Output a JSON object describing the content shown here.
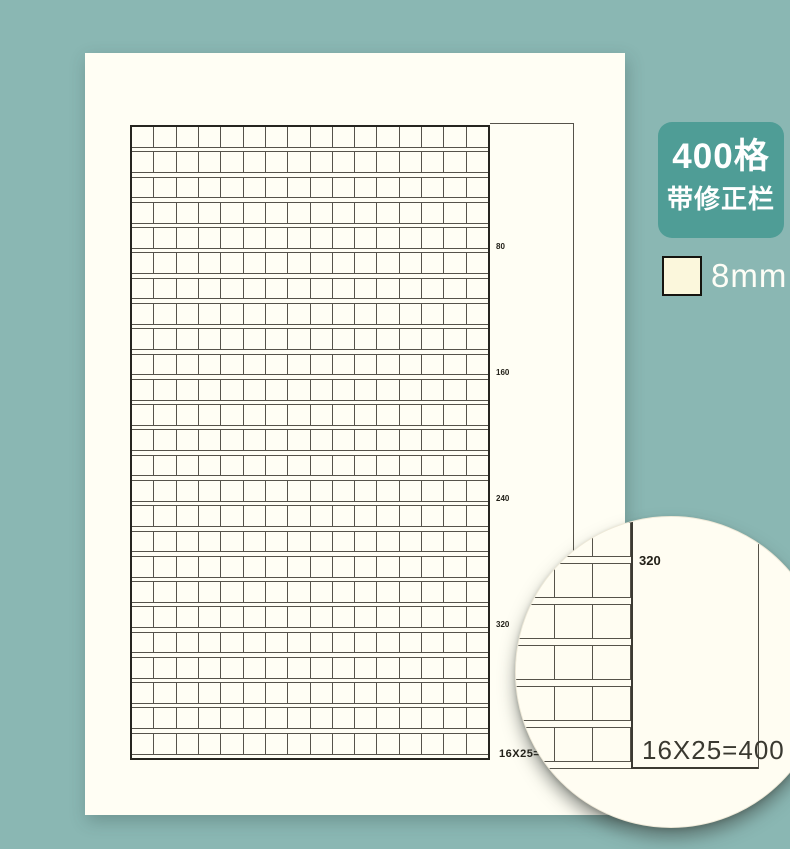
{
  "colors": {
    "background": "#8ab7b3",
    "paper": "#fffef4",
    "badge_bg": "#4f9d96",
    "badge_text": "#ffffff",
    "swatch_fill": "#fbf7dc",
    "grid_line": "#56534a"
  },
  "paper": {
    "header_left": "_____年__月__日",
    "header_right": "星期__天气_____",
    "grid": {
      "cols": 16,
      "rows": 25,
      "row_markers": [
        "80",
        "160",
        "240",
        "320"
      ],
      "total_label": "16X25=400"
    }
  },
  "badge": {
    "line1": "400格",
    "line2": "带修正栏"
  },
  "cell_size": {
    "label": "8mm"
  },
  "magnifier": {
    "grid": {
      "cols": 4,
      "rows": 6
    },
    "marker": "320",
    "total_label": "16X25=400"
  }
}
